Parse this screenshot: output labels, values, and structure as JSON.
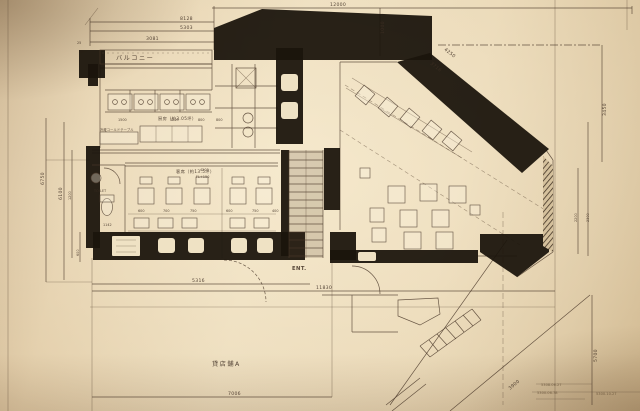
{
  "colors": {
    "paper": "#e8d6b6",
    "ink": "#46342a",
    "wall": "#1a130c"
  },
  "labels": {
    "balcony": "バルコニー",
    "kitchen": "厨房（約3.05坪）",
    "seating": "客席（約13.5坪）",
    "seating_fl": "FL+150",
    "entrance": "ENT.",
    "tenant_area": "貸店舗A",
    "toilet": "TOILET",
    "cold_table": "冷蔵コールドテーブル"
  },
  "dimensions": {
    "top_overall": "12000",
    "top_a": "8128",
    "top_b": "5303",
    "top_c": "3081",
    "top_d": "25",
    "shaft": "1000",
    "diag_a": "4250",
    "diag_b": "3716",
    "right_a": "3450",
    "right_b": "2200",
    "right_c": "2300",
    "right_d": "5700",
    "diag_c": "3900",
    "left_a": "6750",
    "left_b": "6100",
    "left_c": "1200",
    "left_d": "600",
    "bottom_a": "5316",
    "bottom_b": "11830",
    "bottom_c": "7006",
    "kitchen_a": "1500",
    "kitchen_b": "1209",
    "kitchen_c": "800",
    "kitchen_d": "800",
    "seating_w": "4203",
    "seat_a": "600",
    "seat_b": "700",
    "seat_c": "750",
    "seat_d": "600",
    "seat_e": "750",
    "seat_f": "400",
    "wc": "1142"
  },
  "stamps": [
    "5308.06.27",
    "5300.06.78",
    "5300.10.27"
  ]
}
